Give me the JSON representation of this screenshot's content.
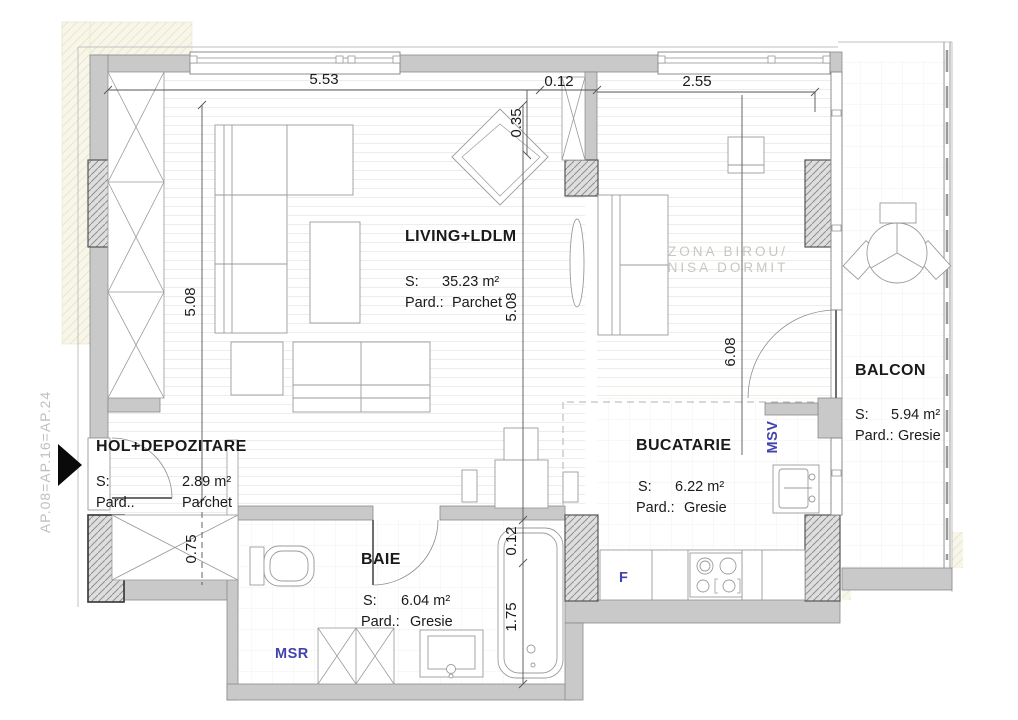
{
  "plan": {
    "apartment_code": "AP.08=AP.16=AP.24",
    "rooms": {
      "living": {
        "name": "LIVING+LDLM",
        "s_label": "S:",
        "area": "35.23 m²",
        "pard_label": "Pard.:",
        "floor": "Parchet"
      },
      "hol": {
        "name": "HOL+DEPOZITARE",
        "s_label": "S:",
        "area": "2.89 m²",
        "pard_label": "Pard..",
        "floor": "Parchet"
      },
      "baie": {
        "name": "BAIE",
        "s_label": "S:",
        "area": "6.04 m²",
        "pard_label": "Pard.:",
        "floor": "Gresie"
      },
      "bucatarie": {
        "name": "BUCATARIE",
        "s_label": "S:",
        "area": "6.22 m²",
        "pard_label": "Pard.:",
        "floor": "Gresie"
      },
      "balcon": {
        "name": "BALCON",
        "s_label": "S:",
        "area": "5.94 m²",
        "pard_label": "Pard.:",
        "floor": "Gresie"
      }
    },
    "zone_label": {
      "line1": "ZONA BIROU/",
      "line2": "NISA DORMIT"
    },
    "dimensions": {
      "top_width": "5.53",
      "top_offset": "0.35",
      "wall_thickness": "0.12",
      "top_right_width": "2.55",
      "left_height": "5.08",
      "mid_height": "5.08",
      "right_height": "6.08",
      "closet_depth": "0.75",
      "bath_wall": "0.12",
      "tub_length": "1.75"
    },
    "annotations": {
      "msv": "MSV",
      "msr": "MSR",
      "fridge": "F"
    },
    "colors": {
      "wall": "#c9c9c9",
      "annotation_blue": "#4343af",
      "zone_text": "#c7c7c2",
      "dim_text": "#1a1a1a"
    }
  }
}
